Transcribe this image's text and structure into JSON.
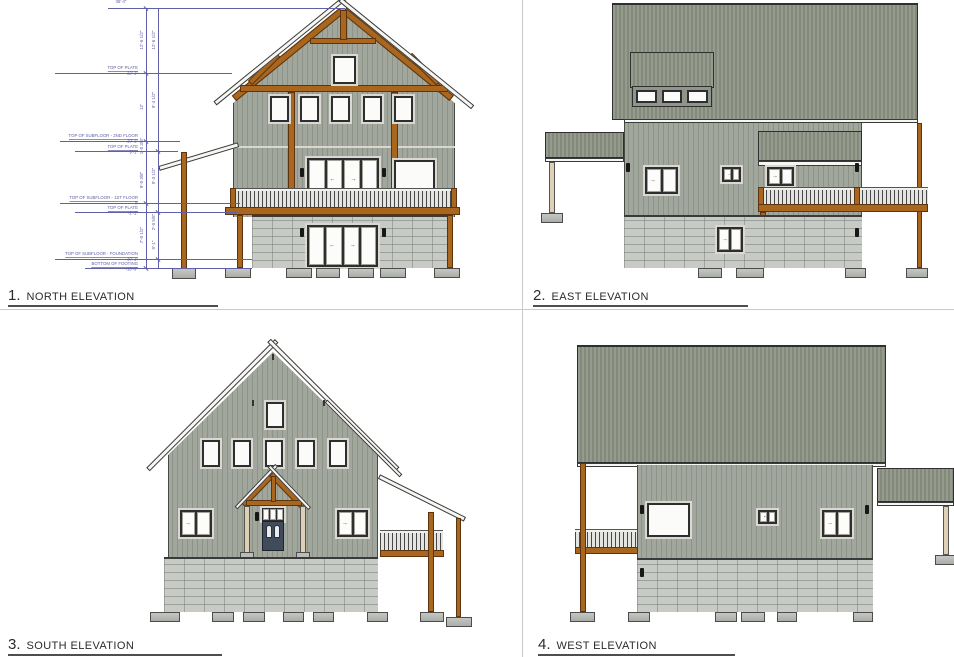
{
  "views": [
    {
      "number": "1.",
      "label": "NORTH  ELEVATION"
    },
    {
      "number": "2.",
      "label": "EAST ELEVATION"
    },
    {
      "number": "3.",
      "label": "SOUTH ELEVATION"
    },
    {
      "number": "4.",
      "label": "WEST ELEVATION"
    }
  ],
  "north_dims": {
    "overall": "36'-4\"",
    "levels": [
      {
        "label": "TOP OF PLATE",
        "value": "22'-1\""
      },
      {
        "label": "TOP OF SUBFLOOR - 2ND FLOOR",
        "value": "10'-1\""
      },
      {
        "label": "TOP OF PLATE",
        "value": "9'-1\""
      },
      {
        "label": "TOP OF SUBFLOOR - 1ST FLOOR",
        "value": "0'"
      },
      {
        "label": "TOP OF PLATE",
        "value": "-1'-1\""
      },
      {
        "label": "TOP OF SUBFLOOR - FOUNDATION",
        "value": "-10'-1\""
      },
      {
        "label": "BOTTOM OF FOOTING",
        "value": "-10'-9\""
      }
    ],
    "chain_left": [
      "12'-6 1/2\"",
      "12'",
      "1'-0 3/8\"",
      "9'-0 3/8\"",
      "7'-0 1/2\""
    ],
    "chain_right": [
      "12'-6 1/2\"",
      "9'-4 1/2\"",
      "9'-3 1/2\"",
      "2'-0 5/8\"",
      "9'-1\""
    ]
  },
  "symbols": {
    "arrow_right": "→",
    "arrow_left": "←"
  },
  "colors": {
    "timber": "#a8661f",
    "siding": "#9da399",
    "roof": "#8d9384",
    "foundation": "#c7cac5",
    "dim": "#6060a8",
    "ink": "#2f2f2f",
    "door": "#414b5c",
    "title": "#2b2b2b"
  }
}
